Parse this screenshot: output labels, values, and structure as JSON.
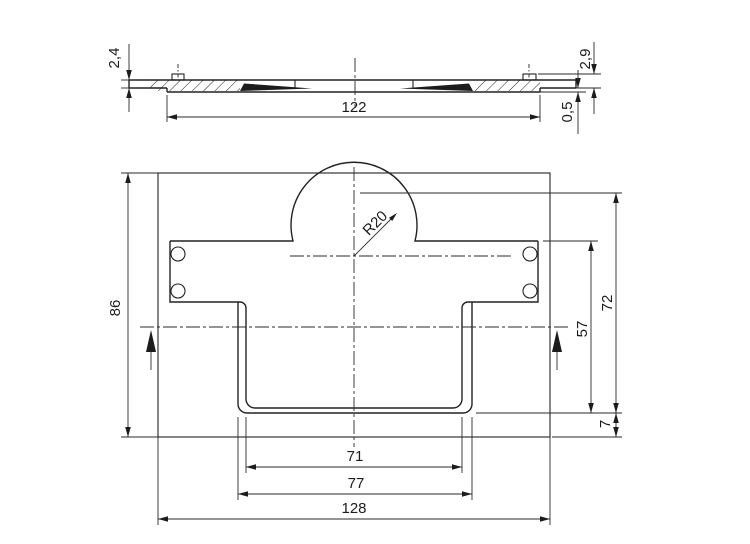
{
  "drawing": {
    "background_color": "#ffffff",
    "line_color": "#222222",
    "section_view": {
      "dimensions": {
        "plate_thickness": "2,4",
        "total_thickness": "2,9",
        "step_depth": "0,5",
        "recess_width": "122"
      }
    },
    "front_view": {
      "dimensions": {
        "plate_height": "86",
        "plate_width": "128",
        "cup_outer_width": "77",
        "cup_inner_width": "71",
        "cup_height": "57",
        "dome_height": "72",
        "bottom_gap": "7",
        "dome_radius": "R20"
      }
    }
  }
}
